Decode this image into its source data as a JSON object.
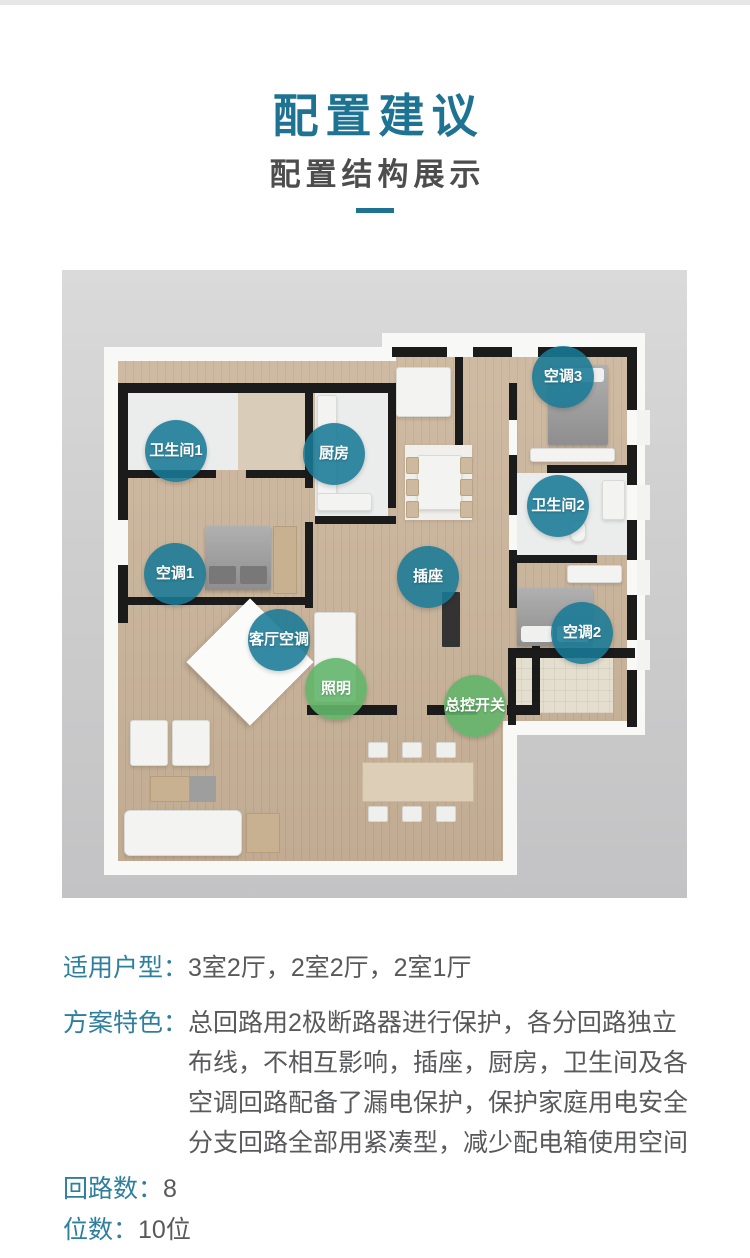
{
  "header": {
    "title": "配置建议",
    "subtitle": "配置结构展示"
  },
  "colors": {
    "accent_teal": "#1e7392",
    "label_teal": "#2e7f9e",
    "badge_teal": "#187a96",
    "badge_green": "#63b66a",
    "body_gray": "#58595b"
  },
  "floorplan": {
    "badges": [
      {
        "label": "卫生间1",
        "color": "teal"
      },
      {
        "label": "厨房",
        "color": "teal"
      },
      {
        "label": "空调3",
        "color": "teal"
      },
      {
        "label": "卫生间2",
        "color": "teal"
      },
      {
        "label": "空调1",
        "color": "teal"
      },
      {
        "label": "插座",
        "color": "teal"
      },
      {
        "label": "空调2",
        "color": "teal"
      },
      {
        "label": "客厅空调",
        "color": "teal"
      },
      {
        "label": "照明",
        "color": "green"
      },
      {
        "label": "总控开关",
        "color": "green"
      }
    ]
  },
  "specs": {
    "household": {
      "label": "适用户型：",
      "value": "3室2厅，2室2厅，2室1厅"
    },
    "features": {
      "label": "方案特色：",
      "lines": [
        "总回路用2极断路器进行保护，各分回路独立",
        "布线，不相互影响，插座，厨房，卫生间及各",
        "空调回路配备了漏电保护，保护家庭用电安全",
        "分支回路全部用紧凑型，减少配电箱使用空间"
      ]
    },
    "circuits": {
      "label": "回路数：",
      "value": "8"
    },
    "positions": {
      "label": "位数：",
      "value": "10位"
    }
  }
}
